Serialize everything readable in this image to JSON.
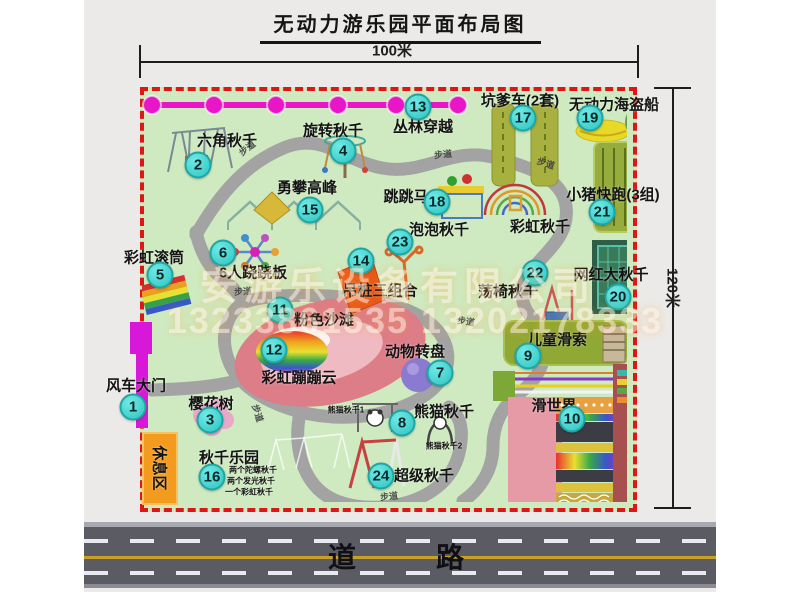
{
  "title": "无动力游乐园平面布局图",
  "dimensions": {
    "top": "100米",
    "right": "120米"
  },
  "road": {
    "label": "道　　路"
  },
  "watermark": {
    "company": "安游乐设备有限公司",
    "phone": "13233861535 13202178333"
  },
  "colors": {
    "map_green": "#cfeac1",
    "border_red": "#dd1616",
    "badge_teal": "#3ed8d4",
    "chain_magenta": "#e816c6",
    "gate_magenta": "#d818d8",
    "rest_orange": "#f39b1e",
    "road_gray": "#5b5b64",
    "beach_pink": "#dd7d88",
    "photo_gray": "#ebeae8"
  },
  "attractions": [
    {
      "num": "1",
      "label": "风车大门",
      "bx": 133,
      "by": 407,
      "lx": 136,
      "ly": 385
    },
    {
      "num": "2",
      "label": "六角秋千",
      "bx": 198,
      "by": 165,
      "lx": 227,
      "ly": 140
    },
    {
      "num": "3",
      "label": "樱花树",
      "bx": 210,
      "by": 420,
      "lx": 211,
      "ly": 403
    },
    {
      "num": "4",
      "label": "旋转秋千",
      "bx": 343,
      "by": 151,
      "lx": 333,
      "ly": 130
    },
    {
      "num": "5",
      "label": "彩虹滚筒",
      "bx": 160,
      "by": 275,
      "lx": 154,
      "ly": 257
    },
    {
      "num": "6",
      "label": "6人跷跷板",
      "bx": 223,
      "by": 253,
      "lx": 253,
      "ly": 272
    },
    {
      "num": "7",
      "label": "动物转盘",
      "bx": 440,
      "by": 373,
      "lx": 415,
      "ly": 351
    },
    {
      "num": "8",
      "label": "熊猫秋千",
      "bx": 402,
      "by": 423,
      "lx": 444,
      "ly": 411
    },
    {
      "num": "9",
      "label": "儿童滑索",
      "bx": 528,
      "by": 356,
      "lx": 557,
      "ly": 339
    },
    {
      "num": "10",
      "label": "滑世界",
      "bx": 572,
      "by": 419,
      "lx": 554,
      "ly": 405
    },
    {
      "num": "11",
      "label": "粉色沙滩",
      "bx": 280,
      "by": 310,
      "lx": 324,
      "ly": 319
    },
    {
      "num": "12",
      "label": "彩虹蹦蹦云",
      "bx": 274,
      "by": 350,
      "lx": 299,
      "ly": 377
    },
    {
      "num": "13",
      "label": "丛林穿越",
      "bx": 418,
      "by": 107,
      "lx": 423,
      "ly": 126
    },
    {
      "num": "14",
      "label": "吊桩三组合",
      "bx": 361,
      "by": 261,
      "lx": 380,
      "ly": 290
    },
    {
      "num": "15",
      "label": "勇攀高峰",
      "bx": 310,
      "by": 210,
      "lx": 307,
      "ly": 187
    },
    {
      "num": "16",
      "label": "秋千乐园",
      "bx": 212,
      "by": 477,
      "lx": 229,
      "ly": 457
    },
    {
      "num": "17",
      "label": "坑爹车(2套)",
      "bx": 523,
      "by": 118,
      "lx": 520,
      "ly": 100
    },
    {
      "num": "18",
      "label": "跳跳马",
      "bx": 437,
      "by": 202,
      "lx": 406,
      "ly": 196
    },
    {
      "num": "19",
      "label": "无动力海盗船",
      "bx": 590,
      "by": 118,
      "lx": 614,
      "ly": 104
    },
    {
      "num": "20",
      "label": "网红大秋千",
      "bx": 618,
      "by": 297,
      "lx": 611,
      "ly": 274
    },
    {
      "num": "21",
      "label": "小猪快跑(3组)",
      "bx": 602,
      "by": 212,
      "lx": 613,
      "ly": 194
    },
    {
      "num": "22",
      "label": "荡椅秋千",
      "bx": 535,
      "by": 273,
      "lx": 508,
      "ly": 291
    },
    {
      "num": "23",
      "label": "泡泡秋千",
      "bx": 400,
      "by": 242,
      "lx": 439,
      "ly": 229
    },
    {
      "num": "24",
      "label": "超级秋千",
      "bx": 381,
      "by": 476,
      "lx": 424,
      "ly": 475
    }
  ],
  "extra_labels": [
    {
      "name": "rainbow-swing-label",
      "text": "彩虹秋千",
      "x": 540,
      "y": 226,
      "fs": 15
    },
    {
      "name": "rest-area-label",
      "text": "休息区",
      "x": 160,
      "y": 468,
      "fs": 15,
      "rot": 90
    },
    {
      "name": "panda-swing-1-label",
      "text": "熊猫秋千1",
      "x": 346,
      "y": 410,
      "fs": 8
    },
    {
      "name": "panda-swing-2-label",
      "text": "熊猫秋千2",
      "x": 444,
      "y": 446,
      "fs": 8
    },
    {
      "name": "swing-list-line-1",
      "text": "两个陀螺秋千",
      "x": 253,
      "y": 470,
      "fs": 8
    },
    {
      "name": "swing-list-line-2",
      "text": "两个发光秋千",
      "x": 251,
      "y": 481,
      "fs": 8
    },
    {
      "name": "swing-list-line-3",
      "text": "一个彩虹秋千",
      "x": 249,
      "y": 492,
      "fs": 8
    }
  ],
  "path_label_text": "步道",
  "path_labels": [
    {
      "x": 247,
      "y": 148,
      "r": -38
    },
    {
      "x": 443,
      "y": 154,
      "r": -6
    },
    {
      "x": 546,
      "y": 163,
      "r": 18
    },
    {
      "x": 243,
      "y": 291,
      "r": -4
    },
    {
      "x": 258,
      "y": 413,
      "r": 72
    },
    {
      "x": 466,
      "y": 321,
      "r": 8
    },
    {
      "x": 389,
      "y": 496,
      "r": -6
    }
  ]
}
